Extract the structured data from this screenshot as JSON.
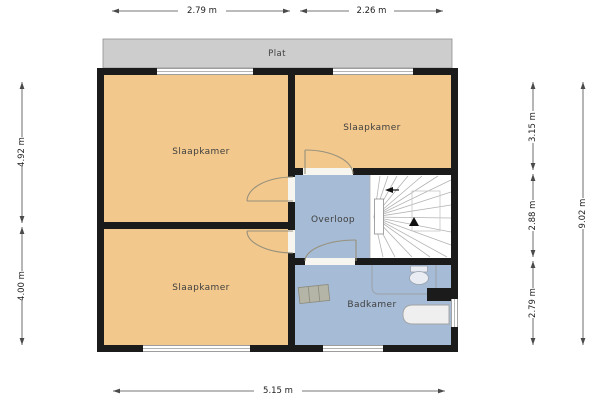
{
  "rooms": {
    "plat": "Plat",
    "bedroom_tl": "Slaapkamer",
    "bedroom_tr": "Slaapkamer",
    "bedroom_bl": "Slaapkamer",
    "landing": "Overloop",
    "bathroom": "Badkamer"
  },
  "dimensions": {
    "top_left": "2.79 m",
    "top_right": "2.26 m",
    "bottom": "5.15 m",
    "left_upper": "4.92 m",
    "left_lower": "4.00 m",
    "right_top": "3.15 m",
    "right_middle": "2.88 m",
    "right_bottom": "2.79 m",
    "right_total": "9.02 m"
  },
  "colors": {
    "bedroom": "#f2c88d",
    "hall": "#a6bbd5",
    "roof": "#cdcdcd",
    "wall": "#1b1b1b",
    "stairs": "#ffffff"
  }
}
